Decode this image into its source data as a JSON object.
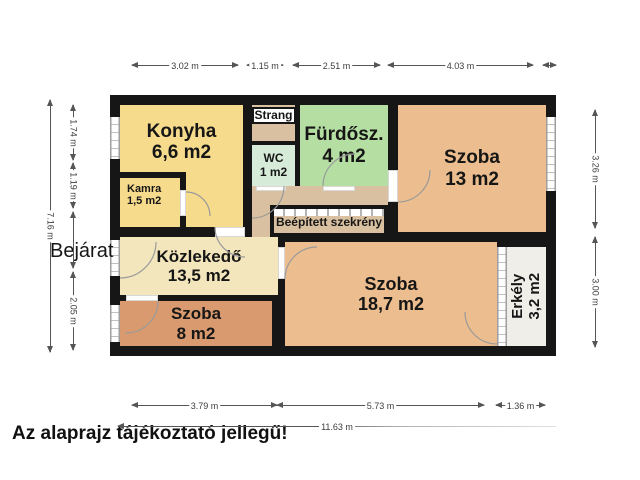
{
  "palette": {
    "wall": "#161616",
    "kitchen_yellow": "#f7db8d",
    "corridor_tan": "#d9c0a0",
    "wc_mint": "#d7ecd8",
    "bathroom_green": "#b5dfa2",
    "room_tan": "#ecbd8e",
    "small_room_orange": "#d89a6e",
    "hall_cream": "#f3e5bc",
    "balcony_gray": "#efeee8"
  },
  "floorplan": {
    "rooms": {
      "konyha": {
        "name": "Konyha",
        "area": "6,6 m2"
      },
      "kamra": {
        "name": "Kamra",
        "area": "1,5 m2"
      },
      "strang": {
        "name": "Strang"
      },
      "wc": {
        "name": "WC",
        "area": "1 m2"
      },
      "furdoszoba": {
        "name": "Fürdősz.",
        "area": "4 m2"
      },
      "szoba_13": {
        "name": "Szoba",
        "area": "13 m2"
      },
      "kozlekedo": {
        "name": "Közlekedő",
        "area": "13,5 m2"
      },
      "beepitett_szekreny": {
        "name": "Beépített szekrény"
      },
      "szoba_18_7": {
        "name": "Szoba",
        "area": "18,7 m2"
      },
      "szoba_8": {
        "name": "Szoba",
        "area": "8 m2"
      },
      "erkely": {
        "name": "Erkély",
        "area": "3,2 m2"
      }
    },
    "entrance_label": "Bejárat",
    "disclaimer": "Az alaprajz tájékoztató jellegű!",
    "dimensions": {
      "top": [
        "3.02 m",
        "1.15 m",
        "2.51 m",
        "4.03 m"
      ],
      "left_overall": "7.16 m",
      "left": [
        "1.74 m",
        "1.19 m",
        "2.05 m"
      ],
      "right": [
        "3.26 m",
        "3.00 m"
      ],
      "bottom": [
        "3.79 m",
        "5.73 m",
        "1.36 m"
      ],
      "bottom_overall": "11.63 m"
    }
  }
}
